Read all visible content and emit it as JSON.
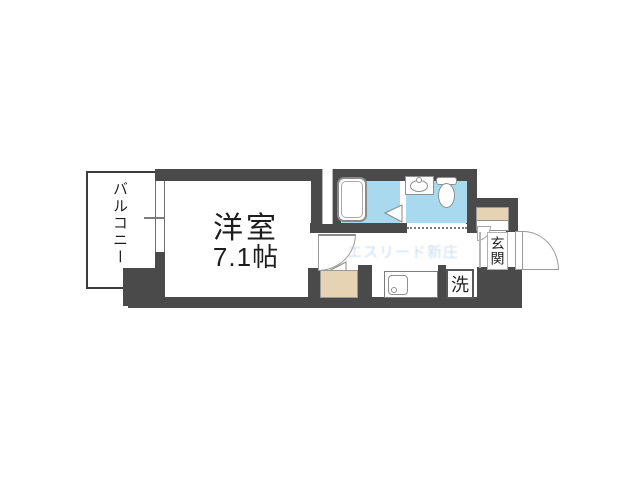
{
  "floorplan": {
    "balcony": {
      "label": "バルコニー"
    },
    "room": {
      "label": "洋室",
      "size": "7.1帖"
    },
    "entrance": {
      "label": "玄関"
    },
    "laundry": {
      "label": "洗"
    },
    "watermark": "エスリード新庄",
    "colors": {
      "wall": "#4a4a4a",
      "water": "#a9d9ef",
      "wood": "#e6d3b3",
      "text": "#222222",
      "watermark": "#9fc3e4"
    }
  }
}
